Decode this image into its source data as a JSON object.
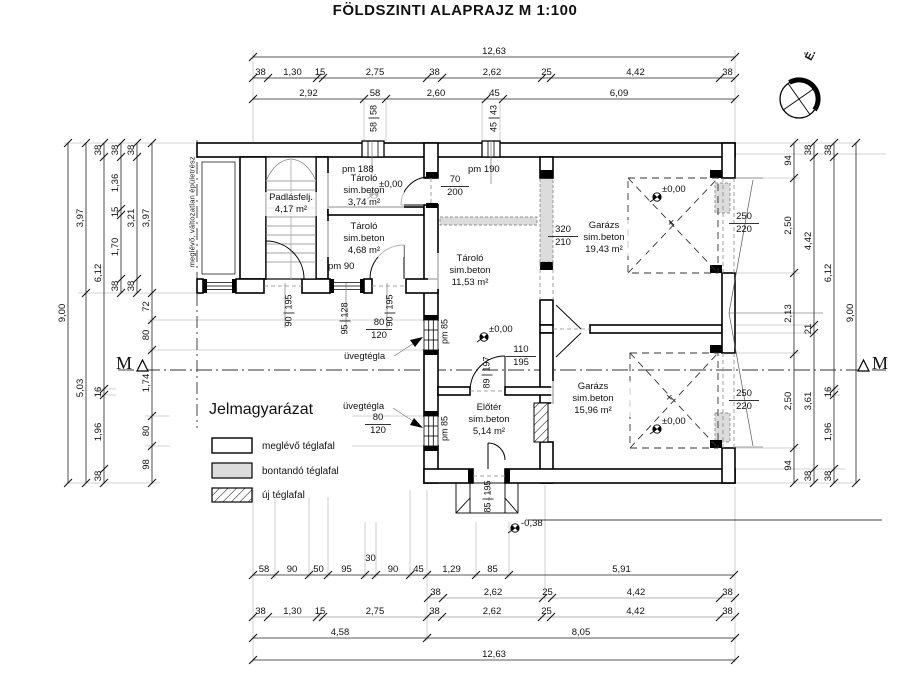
{
  "header": {
    "title": "FÖLDSZINTI ALAPRAJZ   M 1:100"
  },
  "compass": {
    "north_label": "É."
  },
  "section_marker": {
    "label": "M"
  },
  "side_note": "meglévő, változatlan épületrész",
  "legend": {
    "title": "Jelmagyarázat",
    "items": [
      {
        "label": "meglévő téglafal"
      },
      {
        "label": "bontandó téglafal"
      },
      {
        "label": "új téglafal"
      }
    ]
  },
  "rooms": {
    "padlasfeljaro": {
      "name": "Padlásfelj.",
      "area": "4,17 m²"
    },
    "tarolo_374": {
      "name": "Tároló",
      "material": "sim.beton",
      "area": "3,74 m²"
    },
    "tarolo_468": {
      "name": "Tároló",
      "material": "sim.beton",
      "area": "4,68 m²"
    },
    "tarolo_1153": {
      "name": "Tároló",
      "material": "sim.beton",
      "area": "11,53 m²"
    },
    "garazs_1943": {
      "name": "Garázs",
      "material": "sim.beton",
      "area": "19,43 m²"
    },
    "eloter_514": {
      "name": "Előtér",
      "material": "sim.beton",
      "area": "5,14 m²"
    },
    "garazs_1596": {
      "name": "Garázs",
      "material": "sim.beton",
      "area": "15,96 m²"
    }
  },
  "levels": {
    "zero": "±0,00",
    "entrance": "-0,38"
  },
  "notes": {
    "pm188": "pm 188",
    "pm190": "pm 190",
    "pm90": "pm 90",
    "pm85": "pm 85",
    "uvegtegla": "üvegtégla",
    "cross": "×"
  },
  "openings": {
    "door70": [
      "70",
      "200"
    ],
    "demolished320": [
      "320",
      "210"
    ],
    "door110": [
      "110",
      "195"
    ],
    "glassblock80": [
      "80",
      "120"
    ],
    "garagedoor250": [
      "250",
      "220"
    ],
    "door90": [
      "90",
      "195"
    ],
    "window95": [
      "95",
      "128"
    ],
    "leaf89": [
      "89",
      "197"
    ],
    "entrydoor85": [
      "85",
      "195"
    ],
    "chimney58": [
      "58",
      "58"
    ],
    "chimney45": [
      "45",
      "43"
    ]
  },
  "dimensions": {
    "top": {
      "total": [
        "12,63"
      ],
      "row2": [
        "38",
        "1,30",
        "15",
        "2,75",
        "38",
        "2,62",
        "25",
        "4,42",
        "38"
      ],
      "row3": [
        "2,92",
        "58",
        "2,60",
        "45",
        "6,09"
      ]
    },
    "left": {
      "total": [
        "9,00"
      ],
      "row2": [
        "3,97",
        "5,03"
      ],
      "row3": [
        "38",
        "6,12",
        "16",
        "1,96",
        "38"
      ],
      "row4": [
        "38",
        "1,36",
        "15",
        "1,70",
        "38"
      ],
      "row5": [
        "38",
        "3,21",
        "38"
      ],
      "row6": [
        "3,97",
        "72",
        "80",
        "1,74",
        "80",
        "98"
      ]
    },
    "right": {
      "row1": [
        "94",
        "2,50",
        "2,13",
        "2,50",
        "94"
      ],
      "row2": [
        "38",
        "4,42",
        "21",
        "3,61",
        "38"
      ],
      "row3": [
        "38",
        "6,12",
        "16",
        "1,96",
        "38"
      ],
      "total": [
        "9,00"
      ]
    },
    "bottom": {
      "row1": [
        "58",
        "90",
        "50",
        "95",
        "30",
        "90",
        "45",
        "1,29",
        "85",
        "5,91"
      ],
      "row2": [
        "38",
        "2,62",
        "25",
        "4,42",
        "38"
      ],
      "row3": [
        "38",
        "1,30",
        "15",
        "2,75",
        "38",
        "2,62",
        "25",
        "4,42",
        "38"
      ],
      "row4": [
        "4,58",
        "8,05"
      ],
      "total": [
        "12,63"
      ]
    }
  }
}
